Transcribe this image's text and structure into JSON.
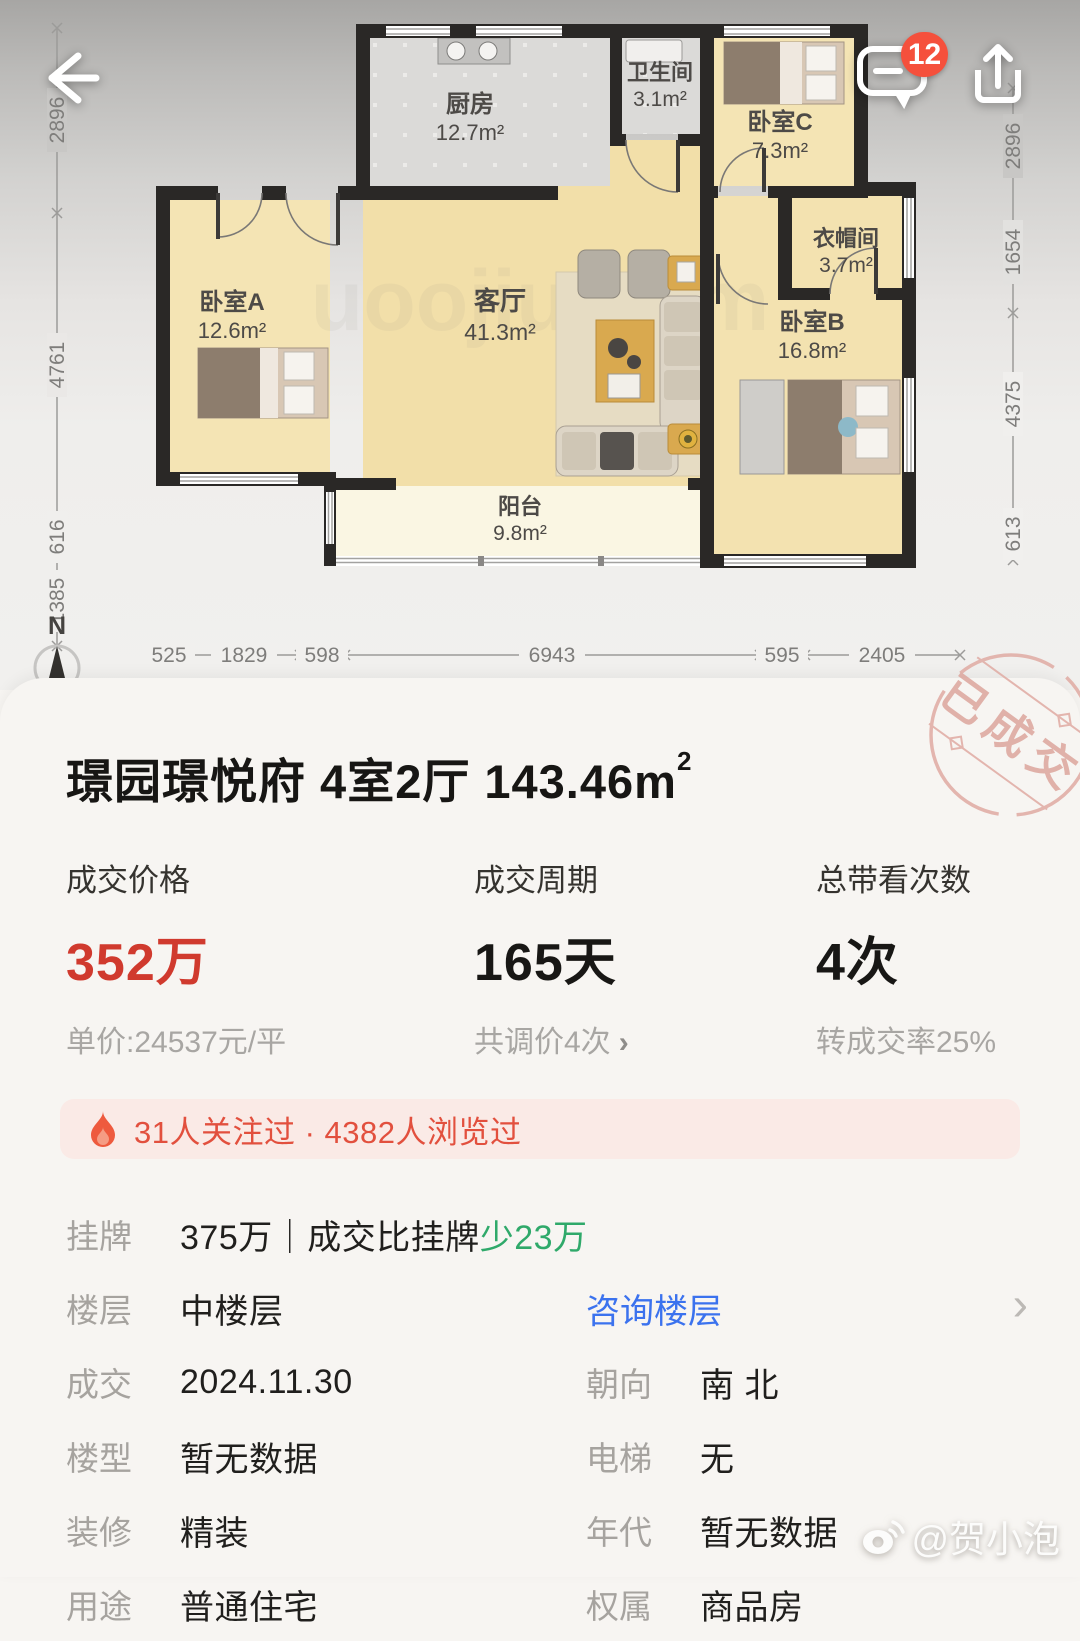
{
  "topbar": {
    "comment_badge": "12"
  },
  "floorplan": {
    "compass": "N",
    "plan_watermark": "uoojiu.com",
    "rooms": {
      "kitchen": {
        "name": "厨房",
        "area": "12.7m²"
      },
      "bath": {
        "name": "卫生间",
        "area": "3.1m²"
      },
      "bedC": {
        "name": "卧室C",
        "area": "7.3m²"
      },
      "cloak": {
        "name": "衣帽间",
        "area": "3.7m²"
      },
      "bedB": {
        "name": "卧室B",
        "area": "16.8m²"
      },
      "bedA": {
        "name": "卧室A",
        "area": "12.6m²"
      },
      "living": {
        "name": "客厅",
        "area": "41.3m²"
      },
      "balcony": {
        "name": "阳台",
        "area": "9.8m²"
      }
    },
    "dims": {
      "left": [
        "2896",
        "4761",
        "616",
        "1385"
      ],
      "right": [
        "2896",
        "1654",
        "4375",
        "613"
      ],
      "bottom": [
        "525",
        "1829",
        "598",
        "6943",
        "595",
        "2405"
      ]
    }
  },
  "card": {
    "stamp": "已成交",
    "title": {
      "main": "璟园璟悦府 4室2厅 143.46m",
      "sup": "2"
    },
    "stats": [
      {
        "label": "成交价格",
        "value": "352万",
        "sub": "单价:24537元/平"
      },
      {
        "label": "成交周期",
        "value": "165天",
        "sub": "共调价4次",
        "arrow": "›"
      },
      {
        "label": "总带看次数",
        "value": "4次",
        "sub": "转成交率25%"
      }
    ],
    "banner": {
      "text": "31人关注过 · 4382人浏览过"
    },
    "rows": {
      "listing": {
        "label": "挂牌",
        "value": "375万｜成交比挂牌",
        "highlight": "少23万"
      },
      "floor": {
        "label": "楼层",
        "value": "中楼层",
        "link": "咨询楼层",
        "chevron": "›"
      },
      "deal": {
        "label": "成交",
        "value": "2024.11.30"
      },
      "orientation": {
        "label": "朝向",
        "value": "南 北"
      },
      "building": {
        "label": "楼型",
        "value": "暂无数据"
      },
      "elevator": {
        "label": "电梯",
        "value": "无"
      },
      "decoration": {
        "label": "装修",
        "value": "精装"
      },
      "era": {
        "label": "年代",
        "value": "暂无数据"
      },
      "usage": {
        "label": "用途",
        "value": "普通住宅"
      },
      "ownership": {
        "label": "权属",
        "value": "商品房"
      }
    }
  },
  "watermark": "@贺小泡"
}
